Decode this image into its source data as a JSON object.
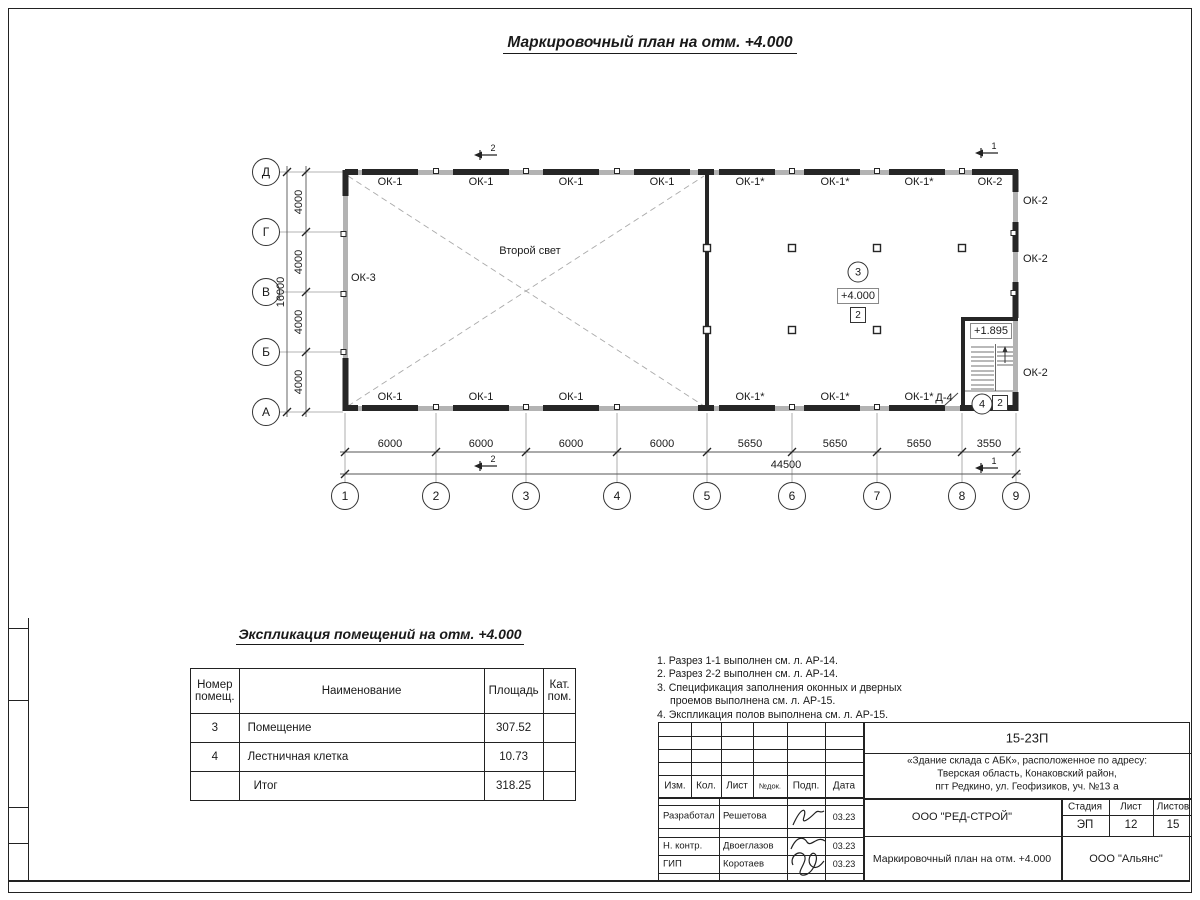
{
  "sheet": {
    "title": "Маркировочный план на отм. +4.000"
  },
  "plan": {
    "second_light": "Второй свет",
    "left_window": "ОК-3",
    "top_windows": [
      "ОК-1",
      "ОК-1",
      "ОК-1",
      "ОК-1",
      "ОК-1*",
      "ОК-1*",
      "ОК-1*",
      "ОК-2"
    ],
    "bottom_windows": [
      "ОК-1",
      "ОК-1",
      "ОК-1",
      "ОК-1*",
      "ОК-1*",
      "ОК-1*"
    ],
    "right_windows": [
      "ОК-2",
      "ОК-2",
      "ОК-2"
    ],
    "axes_rows": [
      "Д",
      "Г",
      "В",
      "Б",
      "А"
    ],
    "axes_cols": [
      "1",
      "2",
      "3",
      "4",
      "5",
      "6",
      "7",
      "8",
      "9"
    ],
    "dims_h": [
      "6000",
      "6000",
      "6000",
      "6000",
      "5650",
      "5650",
      "5650",
      "3550"
    ],
    "dim_h_total": "44500",
    "dims_v": [
      "4000",
      "4000",
      "4000",
      "4000"
    ],
    "dim_v_total": "16000",
    "room3": {
      "num": "3",
      "elev": "+4.000",
      "tag": "2"
    },
    "stair": {
      "elev": "+1.895",
      "door": "Д-4",
      "num": "4",
      "tag": "2"
    },
    "sections": {
      "top2": "2",
      "top1": "1",
      "bot2": "2",
      "bot1": "1"
    }
  },
  "expl": {
    "title": "Экспликация помещений на отм. +4.000",
    "headers": [
      "Номер помещ.",
      "Наименование",
      "Площадь",
      "Кат. пом."
    ],
    "rows": [
      {
        "num": "3",
        "name": "Помещение",
        "area": "307.52",
        "cat": ""
      },
      {
        "num": "4",
        "name": "Лестничная клетка",
        "area": "10.73",
        "cat": ""
      },
      {
        "num": "",
        "name": "Итог",
        "area": "318.25",
        "cat": ""
      }
    ]
  },
  "notes": {
    "lines": [
      "1. Разрез 1-1 выполнен см. л. АР-14.",
      "2. Разрез 2-2 выполнен см. л. АР-14.",
      "3. Спецификация заполнения оконных и дверных",
      "проемов выполнена см. л. АР-15.",
      "4. Экспликация полов выполнена см. л. АР-15."
    ]
  },
  "titleblock": {
    "doc_number": "15-23П",
    "address": [
      "«Здание склада с АБК», расположенное по адресу:",
      "Тверская область, Конаковский район,",
      "пгт Редкино, ул. Геофизиков, уч. №13 а"
    ],
    "cols": [
      "Изм.",
      "Кол.",
      "Лист",
      "№док.",
      "Подп.",
      "Дата"
    ],
    "rows": [
      {
        "role": "Разработал",
        "name": "Решетова",
        "date": "03.23"
      },
      {
        "role": "Н. контр.",
        "name": "Двоеглазов",
        "date": "03.23"
      },
      {
        "role": "ГИП",
        "name": "Коротаев",
        "date": "03.23"
      }
    ],
    "company": "ООО \"РЕД-СТРОЙ\"",
    "drawing_title": "Маркировочный план на отм. +4.000",
    "firm": "ООО \"Альянс\"",
    "stage_label": "Стадия",
    "sheet_label": "Лист",
    "sheets_label": "Листов",
    "stage": "ЭП",
    "sheet_no": "12",
    "sheets_total": "15"
  }
}
